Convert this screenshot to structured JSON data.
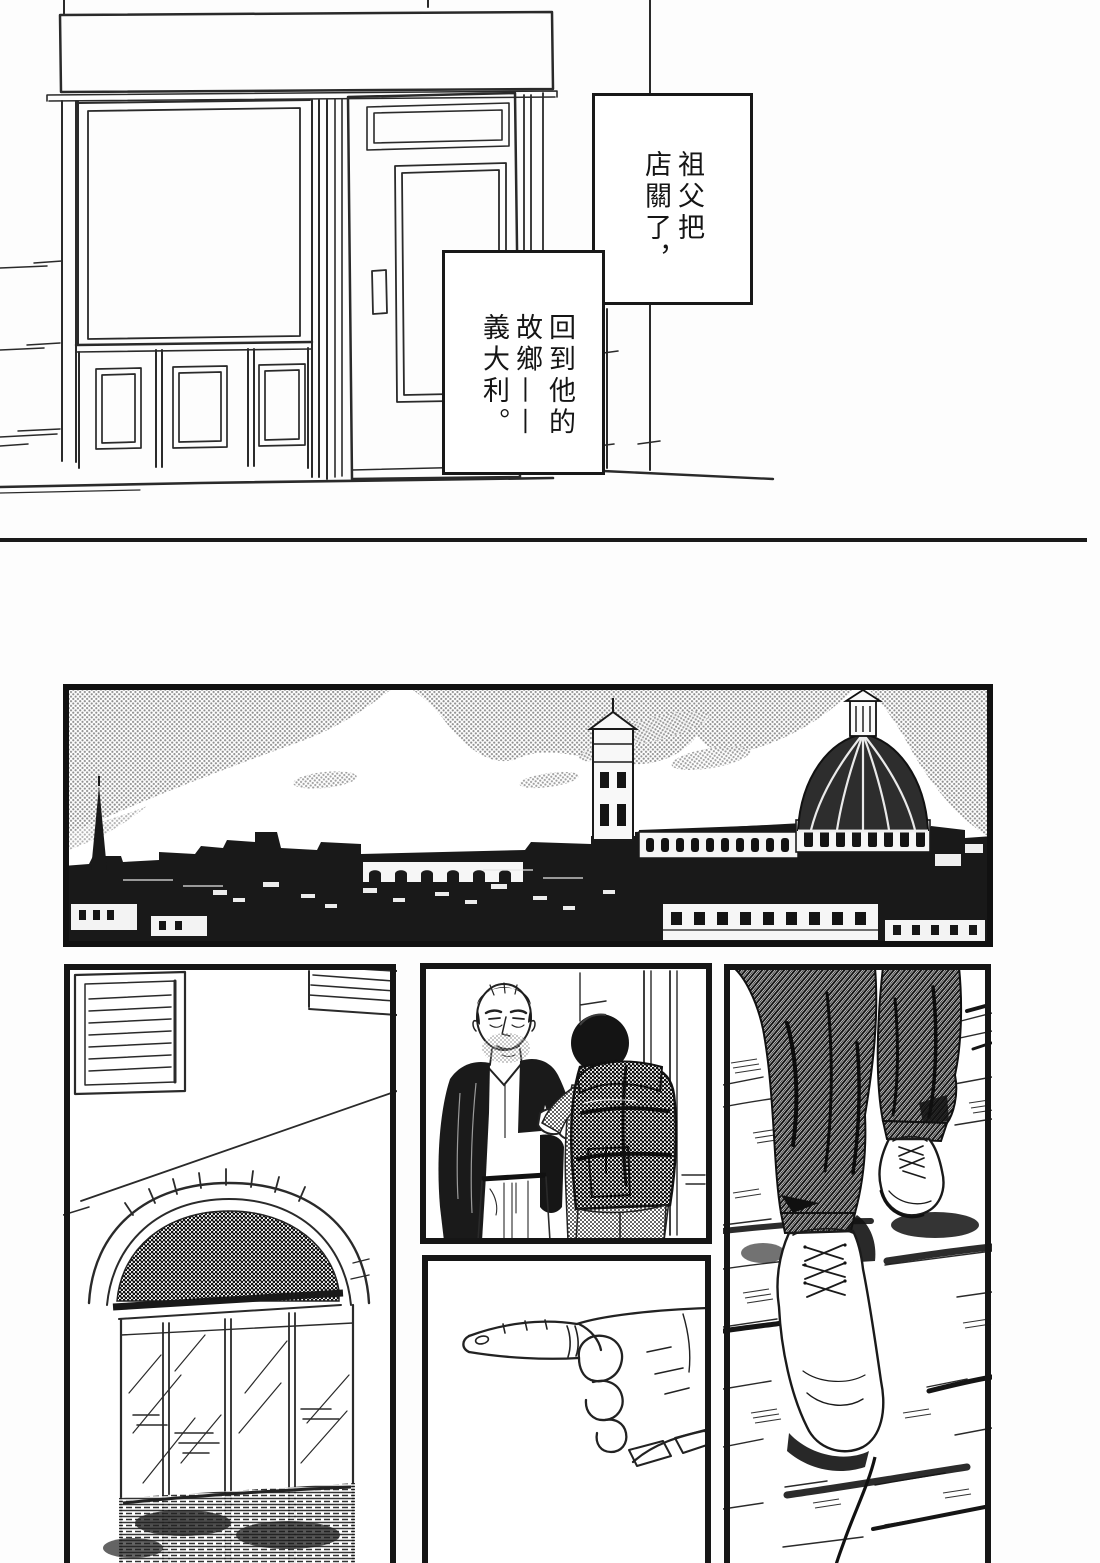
{
  "page": {
    "kind": "manga page",
    "script": "traditional-chinese",
    "paper_color": "#fdfdfd",
    "ink_color": "#1a1a1a"
  },
  "captions": [
    {
      "text": "祖父把店關了，",
      "columns": [
        "祖父把",
        "店關了，"
      ]
    },
    {
      "text": "回到他的故鄉——義大利。",
      "columns": [
        "回到他的",
        "故鄉——",
        "義大利。"
      ]
    }
  ],
  "panels": [
    {
      "name": "storefront",
      "desc": "closed shop facade: awning band, display window, panelled base, open glass door"
    },
    {
      "name": "florence-skyline",
      "desc": "panorama of Florence with Giotto's campanile, the Duomo dome and clouded sky"
    },
    {
      "name": "arched-doorway",
      "desc": "stone arch with dark fanlight over glass doors, shuttered window above"
    },
    {
      "name": "meeting",
      "desc": "older man with hand in pocket greets young traveller carrying a large backpack"
    },
    {
      "name": "pointing-hand",
      "desc": "close-up of a hand pointing left"
    },
    {
      "name": "walking-feet",
      "desc": "legs in dark trousers and white lace-up shoes on cobblestones"
    }
  ]
}
